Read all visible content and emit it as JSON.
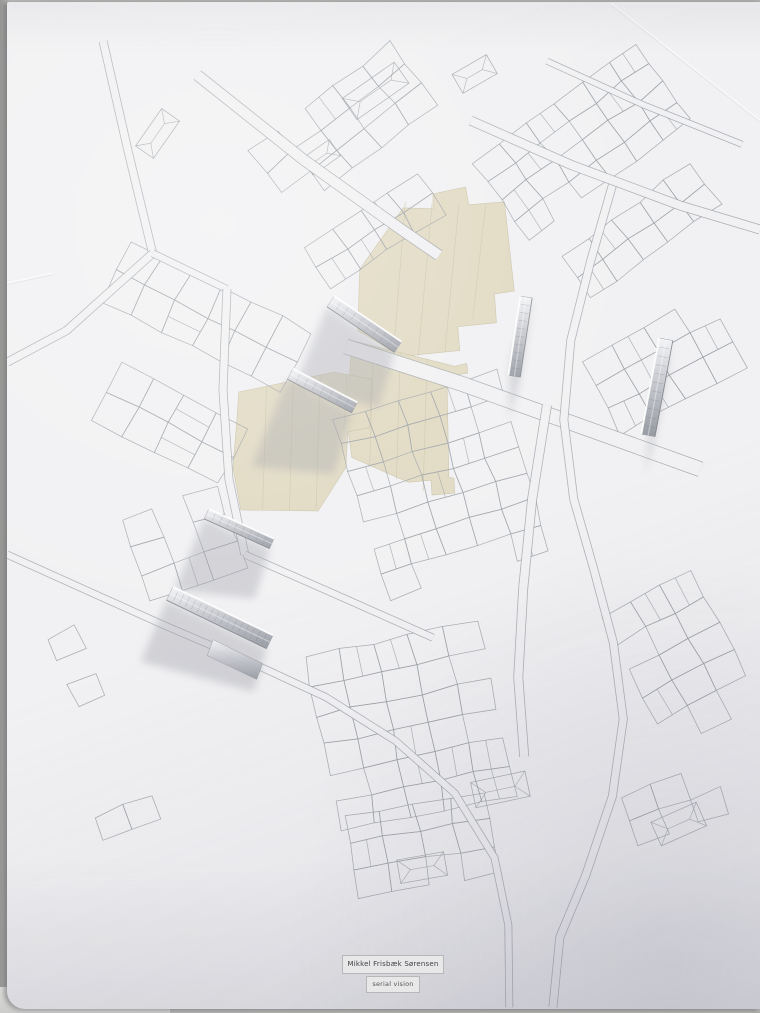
{
  "scene": {
    "paper_color": "#f1f1f3",
    "line_color": "#9aa0a5",
    "tape_color": "#ded7bd",
    "tape_edge_color": "#c9c2a6",
    "tape_seam_color": "#ccc5a9",
    "shadow_color": "#9b9da6",
    "metal_light": "#f4f5f7",
    "metal_mid": "#c6c8ce",
    "metal_dark": "#9599a1",
    "background_color": "#b0b0ae",
    "seed": 7
  },
  "label_plate": {
    "author": "Mikkel Frisbæk Sørensen",
    "subtitle": "serial vision"
  },
  "map": {
    "blocks": [
      {
        "x": 245,
        "y": 150,
        "angle": -38,
        "nx": 5,
        "cw": 36,
        "ny": 3,
        "ch": 26,
        "jitter": 2,
        "skip": 0.14
      },
      {
        "x": 300,
        "y": 245,
        "angle": -33,
        "nx": 4,
        "cw": 34,
        "ny": 2,
        "ch": 25,
        "jitter": 2,
        "skip": 0.12
      },
      {
        "x": 95,
        "y": 300,
        "angle": -63,
        "nx": 2,
        "cw": 34,
        "ny": 6,
        "ch": 34,
        "jitter": 2,
        "skip": 0.1
      },
      {
        "x": 85,
        "y": 420,
        "angle": -63,
        "nx": 2,
        "cw": 32,
        "ny": 4,
        "ch": 36,
        "jitter": 2,
        "skip": 0.12
      },
      {
        "x": 470,
        "y": 160,
        "angle": -36,
        "nx": 6,
        "cw": 34,
        "ny": 4,
        "ch": 24,
        "jitter": 2,
        "skip": 0.16
      },
      {
        "x": 560,
        "y": 255,
        "angle": -36,
        "nx": 5,
        "cw": 32,
        "ny": 2,
        "ch": 26,
        "jitter": 2,
        "skip": 0.12
      },
      {
        "x": 580,
        "y": 360,
        "angle": -28,
        "nx": 4,
        "cw": 36,
        "ny": 3,
        "ch": 28,
        "jitter": 2,
        "skip": 0.12
      },
      {
        "x": 330,
        "y": 420,
        "angle": -17,
        "nx": 5,
        "cw": 34,
        "ny": 7,
        "ch": 27,
        "jitter": 2,
        "skip": 0.15
      },
      {
        "x": 115,
        "y": 520,
        "angle": -20,
        "nx": 3,
        "cw": 34,
        "ny": 3,
        "ch": 30,
        "jitter": 2,
        "skip": 0.12
      },
      {
        "x": 300,
        "y": 660,
        "angle": -12,
        "nx": 5,
        "cw": 36,
        "ny": 6,
        "ch": 30,
        "jitter": 2,
        "skip": 0.16
      },
      {
        "x": 340,
        "y": 820,
        "angle": -10,
        "nx": 4,
        "cw": 36,
        "ny": 3,
        "ch": 28,
        "jitter": 2,
        "skip": 0.14
      },
      {
        "x": 600,
        "y": 620,
        "angle": -28,
        "nx": 3,
        "cw": 34,
        "ny": 5,
        "ch": 30,
        "jitter": 2,
        "skip": 0.13
      },
      {
        "x": 620,
        "y": 800,
        "angle": -20,
        "nx": 3,
        "cw": 32,
        "ny": 2,
        "ch": 26,
        "jitter": 2,
        "skip": 0.15
      },
      {
        "x": 90,
        "y": 820,
        "angle": -20,
        "nx": 2,
        "cw": 30,
        "ny": 2,
        "ch": 24,
        "jitter": 2,
        "skip": 0.35
      },
      {
        "x": 40,
        "y": 640,
        "angle": -25,
        "nx": 2,
        "cw": 30,
        "ny": 3,
        "ch": 26,
        "jitter": 2,
        "skip": 0.3
      }
    ],
    "roofs": [
      {
        "x": 372,
        "y": 88,
        "w": 64,
        "h": 26,
        "angle": -35
      },
      {
        "x": 472,
        "y": 71,
        "w": 40,
        "h": 22,
        "angle": -30
      },
      {
        "x": 152,
        "y": 131,
        "w": 46,
        "h": 22,
        "angle": -55
      },
      {
        "x": 498,
        "y": 793,
        "w": 56,
        "h": 26,
        "angle": -12
      },
      {
        "x": 419,
        "y": 872,
        "w": 48,
        "h": 24,
        "angle": -10
      },
      {
        "x": 678,
        "y": 828,
        "w": 50,
        "h": 26,
        "angle": -24
      },
      {
        "x": 317,
        "y": 155,
        "w": 34,
        "h": 20,
        "angle": -35
      }
    ],
    "roads": [
      {
        "w": 9,
        "pts": [
          [
            97,
            38
          ],
          [
            122,
            148
          ],
          [
            147,
            252
          ]
        ]
      },
      {
        "w": 9,
        "pts": [
          [
            147,
            252
          ],
          [
            60,
            330
          ],
          [
            0,
            362
          ]
        ]
      },
      {
        "w": 8,
        "pts": [
          [
            147,
            252
          ],
          [
            222,
            288
          ]
        ]
      },
      {
        "w": 12,
        "pts": [
          [
            192,
            72
          ],
          [
            300,
            158
          ],
          [
            398,
            228
          ],
          [
            436,
            254
          ]
        ]
      },
      {
        "w": 16,
        "pts": [
          [
            342,
            346
          ],
          [
            460,
            384
          ],
          [
            600,
            434
          ],
          [
            700,
            470
          ]
        ]
      },
      {
        "w": 9,
        "pts": [
          [
            222,
            288
          ],
          [
            218,
            390
          ],
          [
            224,
            480
          ],
          [
            240,
            556
          ]
        ]
      },
      {
        "w": 8,
        "pts": [
          [
            240,
            556
          ],
          [
            340,
            600
          ],
          [
            430,
            640
          ]
        ]
      },
      {
        "w": 8,
        "pts": [
          [
            0,
            556
          ],
          [
            80,
            592
          ],
          [
            160,
            628
          ],
          [
            242,
            663
          ],
          [
            322,
            700
          ],
          [
            392,
            744
          ],
          [
            452,
            797
          ],
          [
            492,
            862
          ],
          [
            506,
            930
          ],
          [
            507,
            1013
          ]
        ]
      },
      {
        "w": 9,
        "pts": [
          [
            612,
            180
          ],
          [
            589,
            260
          ],
          [
            569,
            340
          ],
          [
            562,
            420
          ],
          [
            572,
            500
          ],
          [
            592,
            570
          ],
          [
            612,
            645
          ],
          [
            622,
            722
          ],
          [
            611,
            800
          ],
          [
            584,
            880
          ],
          [
            558,
            942
          ],
          [
            551,
            1013
          ]
        ]
      },
      {
        "w": 10,
        "pts": [
          [
            468,
            118
          ],
          [
            570,
            163
          ],
          [
            680,
            204
          ],
          [
            760,
            228
          ]
        ]
      },
      {
        "w": 7,
        "pts": [
          [
            545,
            58
          ],
          [
            642,
            102
          ],
          [
            742,
            142
          ]
        ]
      },
      {
        "w": 10,
        "pts": [
          [
            545,
            405
          ],
          [
            530,
            500
          ],
          [
            521,
            590
          ],
          [
            516,
            680
          ],
          [
            522,
            760
          ]
        ]
      }
    ],
    "tape_patches": [
      {
        "points": [
          [
            430,
            192
          ],
          [
            463,
            185
          ],
          [
            466,
            203
          ],
          [
            502,
            200
          ],
          [
            512,
            290
          ],
          [
            492,
            293
          ],
          [
            494,
            322
          ],
          [
            455,
            326
          ],
          [
            457,
            350
          ],
          [
            398,
            356
          ],
          [
            354,
            330
          ],
          [
            356,
            268
          ],
          [
            400,
            206
          ],
          [
            430,
            207
          ]
        ],
        "seams": [
          [
            402,
            200,
            390,
            354
          ],
          [
            429,
            202,
            415,
            356
          ],
          [
            456,
            203,
            442,
            352
          ],
          [
            483,
            204,
            470,
            318
          ]
        ]
      },
      {
        "points": [
          [
            348,
            340
          ],
          [
            452,
            366
          ],
          [
            464,
            363
          ],
          [
            465,
            373
          ],
          [
            444,
            376
          ],
          [
            446,
            478
          ],
          [
            451,
            479
          ],
          [
            452,
            494
          ],
          [
            429,
            496
          ],
          [
            428,
            481
          ],
          [
            405,
            483
          ],
          [
            348,
            458
          ],
          [
            341,
            404
          ],
          [
            346,
            372
          ]
        ],
        "seams": [
          [
            370,
            345,
            366,
            468
          ],
          [
            397,
            352,
            393,
            480
          ],
          [
            424,
            358,
            420,
            492
          ]
        ]
      },
      {
        "points": [
          [
            234,
            392
          ],
          [
            330,
            372
          ],
          [
            368,
            379
          ],
          [
            366,
            428
          ],
          [
            344,
            432
          ],
          [
            342,
            468
          ],
          [
            314,
            512
          ],
          [
            236,
            511
          ],
          [
            228,
            468
          ],
          [
            232,
            420
          ]
        ],
        "seams": [
          [
            262,
            386,
            258,
            510
          ],
          [
            289,
            380,
            285,
            512
          ],
          [
            316,
            376,
            312,
            510
          ],
          [
            343,
            374,
            340,
            430
          ]
        ]
      }
    ],
    "markers": [
      {
        "foot": [
          323,
          306,
          391,
          352
        ],
        "h": 13,
        "shadow_len": 80,
        "shadow_drift": -32,
        "scratches": 8
      },
      {
        "foot": [
          283,
          379,
          348,
          413
        ],
        "h": 12,
        "shadow_len": 88,
        "shadow_drift": -36,
        "scratches": 7
      },
      {
        "foot": [
          530,
          297,
          518,
          377
        ],
        "h": 12,
        "shadow_len": 62,
        "shadow_drift": -22,
        "scratches": 9
      },
      {
        "foot": [
          672,
          340,
          654,
          437
        ],
        "h": 14,
        "shadow_len": 58,
        "shadow_drift": -20,
        "scratches": 10
      },
      {
        "foot": [
          199,
          520,
          265,
          550
        ],
        "h": 11,
        "shadow_len": 72,
        "shadow_drift": -30,
        "scratches": 8
      },
      {
        "foot": [
          161,
          602,
          262,
          651
        ],
        "h": 15,
        "shadow_len": 62,
        "shadow_drift": -26,
        "scratches": 16,
        "flap": [
          [
            208,
            642
          ],
          [
            258,
            666
          ],
          [
            252,
            682
          ],
          [
            202,
            658
          ]
        ]
      }
    ],
    "creases": [
      [
        610,
        0,
        760,
        118
      ],
      [
        0,
        282,
        46,
        272
      ]
    ]
  }
}
